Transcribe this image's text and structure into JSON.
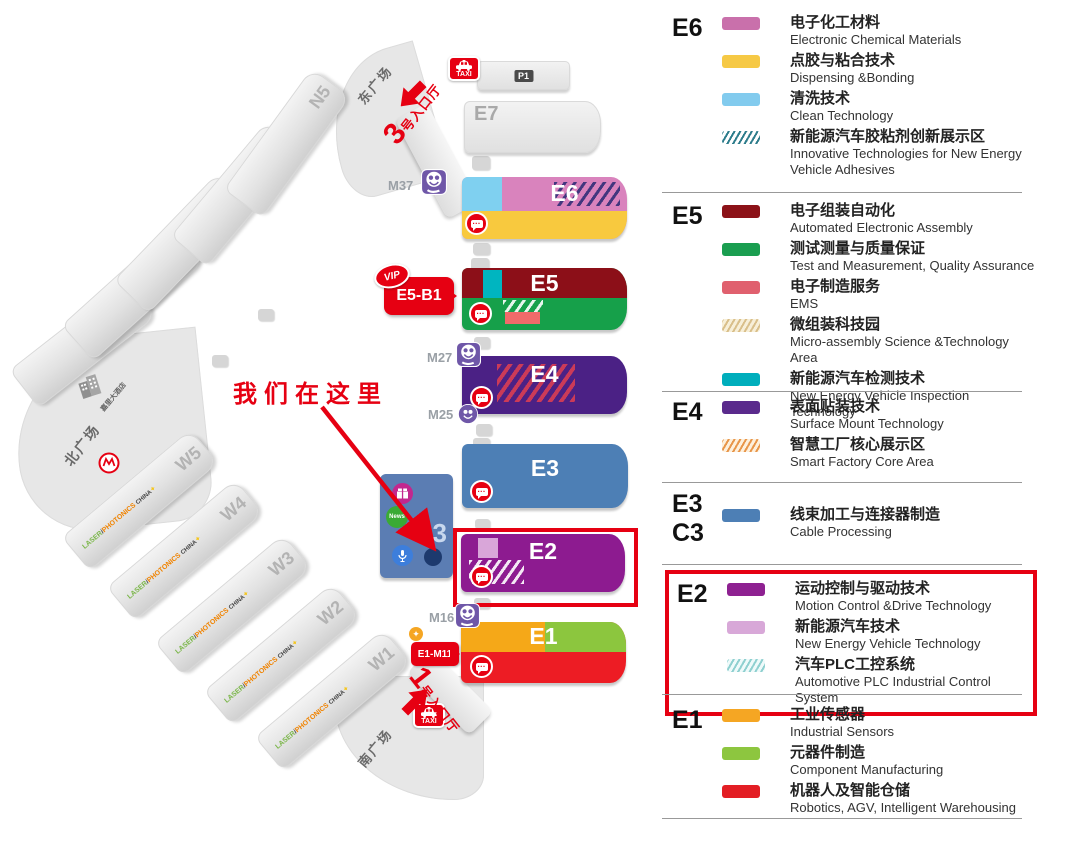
{
  "annotation": {
    "we_are_here": "我们在这里"
  },
  "map": {
    "plazas": {
      "east": "东广场",
      "south": "南广场",
      "north": "北广场"
    },
    "hotel_label": "嘉里大酒店",
    "entrance_3": {
      "num": "3",
      "rest": "号入口厅"
    },
    "entrance_1": {
      "num": "1",
      "rest": "号入口厅"
    },
    "taxi_label": "TAXI",
    "parking_label": "P1",
    "vip_badge": {
      "vip": "VIP",
      "label": "E5-B1"
    },
    "e1_gate_badge": "E1-M11",
    "markers": {
      "m37": "M37",
      "m27": "M27",
      "m25": "M25",
      "m16": "M16"
    },
    "gray_halls": {
      "north": [
        "N1",
        "N2",
        "N3",
        "N4",
        "N5"
      ],
      "west": [
        "W1",
        "W2",
        "W3",
        "W4",
        "W5"
      ]
    },
    "brand": {
      "laser": "LASER",
      "i": "i",
      "photonics": "PHOTONICS",
      "china": "CHINA",
      "star": "✦"
    },
    "hall_labels": {
      "e7": "E7",
      "e6": "E6",
      "e5": "E5",
      "e4": "E4",
      "e3": "E3",
      "c3": "C3",
      "e2": "E2",
      "e1": "E1"
    },
    "c3_news": "News",
    "accent_red": "#e60012"
  },
  "legend": {
    "colors": {
      "pink": "#c970ab",
      "yellow": "#f6c945",
      "lightblue": "#82cbee",
      "darkred": "#8c1218",
      "green": "#1a9e50",
      "salmon": "#e0606e",
      "teal": "#00aebc",
      "purple": "#5a2a8c",
      "blue": "#4d7fb5",
      "magenta": "#8e2191",
      "lightpink": "#d8a8d8",
      "orange": "#f5a623",
      "yellowgreen": "#8dc63f",
      "red": "#e31e24"
    },
    "sections": [
      {
        "code": "E6",
        "highlight": false,
        "items": [
          {
            "zh": "电子化工材料",
            "en": "Electronic Chemical Materials",
            "swatch": "pink"
          },
          {
            "zh": "点胶与粘合技术",
            "en": "Dispensing &Bonding",
            "swatch": "yellow"
          },
          {
            "zh": "清洗技术",
            "en": "Clean Technology",
            "swatch": "lightblue"
          },
          {
            "zh": "新能源汽车胶粘剂创新展示区",
            "en": "Innovative Technologies for New Energy Vehicle Adhesives",
            "swatch": "hatch-teal"
          }
        ]
      },
      {
        "code": "E5",
        "highlight": false,
        "items": [
          {
            "zh": "电子组装自动化",
            "en": "Automated Electronic Assembly",
            "swatch": "darkred"
          },
          {
            "zh": "测试测量与质量保证",
            "en": "Test and Measurement, Quality Assurance",
            "swatch": "green"
          },
          {
            "zh": "电子制造服务",
            "en": "EMS",
            "swatch": "salmon"
          },
          {
            "zh": "微组装科技园",
            "en": "Micro-assembly Science &Technology Area",
            "swatch": "hatch-tan"
          },
          {
            "zh": "新能源汽车检测技术",
            "en": "New Energy Vehicle Inspection Technology",
            "swatch": "teal"
          }
        ]
      },
      {
        "code": "E4",
        "highlight": false,
        "items": [
          {
            "zh": "表面贴装技术",
            "en": "Surface Mount Technology",
            "swatch": "purple"
          },
          {
            "zh": "智慧工厂核心展示区",
            "en": "Smart Factory Core Area",
            "swatch": "hatch-orange"
          }
        ]
      },
      {
        "code": "E3",
        "code2": "C3",
        "highlight": false,
        "items": [
          {
            "zh": "线束加工与连接器制造",
            "en": "Cable Processing",
            "swatch": "blue"
          }
        ]
      },
      {
        "code": "E2",
        "highlight": true,
        "items": [
          {
            "zh": "运动控制与驱动技术",
            "en": "Motion Control &Drive Technology",
            "swatch": "magenta"
          },
          {
            "zh": "新能源汽车技术",
            "en": "New Energy Vehicle Technology",
            "swatch": "lightpink"
          },
          {
            "zh": "汽车PLC工控系统",
            "en": "Automotive PLC Industrial Control System",
            "swatch": "hatch-lightteal"
          }
        ]
      },
      {
        "code": "E1",
        "highlight": false,
        "items": [
          {
            "zh": "工业传感器",
            "en": "Industrial Sensors",
            "swatch": "orange"
          },
          {
            "zh": "元器件制造",
            "en": "Component Manufacturing",
            "swatch": "yellowgreen"
          },
          {
            "zh": "机器人及智能仓储",
            "en": "Robotics, AGV, Intelligent Warehousing",
            "swatch": "red"
          }
        ]
      }
    ]
  }
}
